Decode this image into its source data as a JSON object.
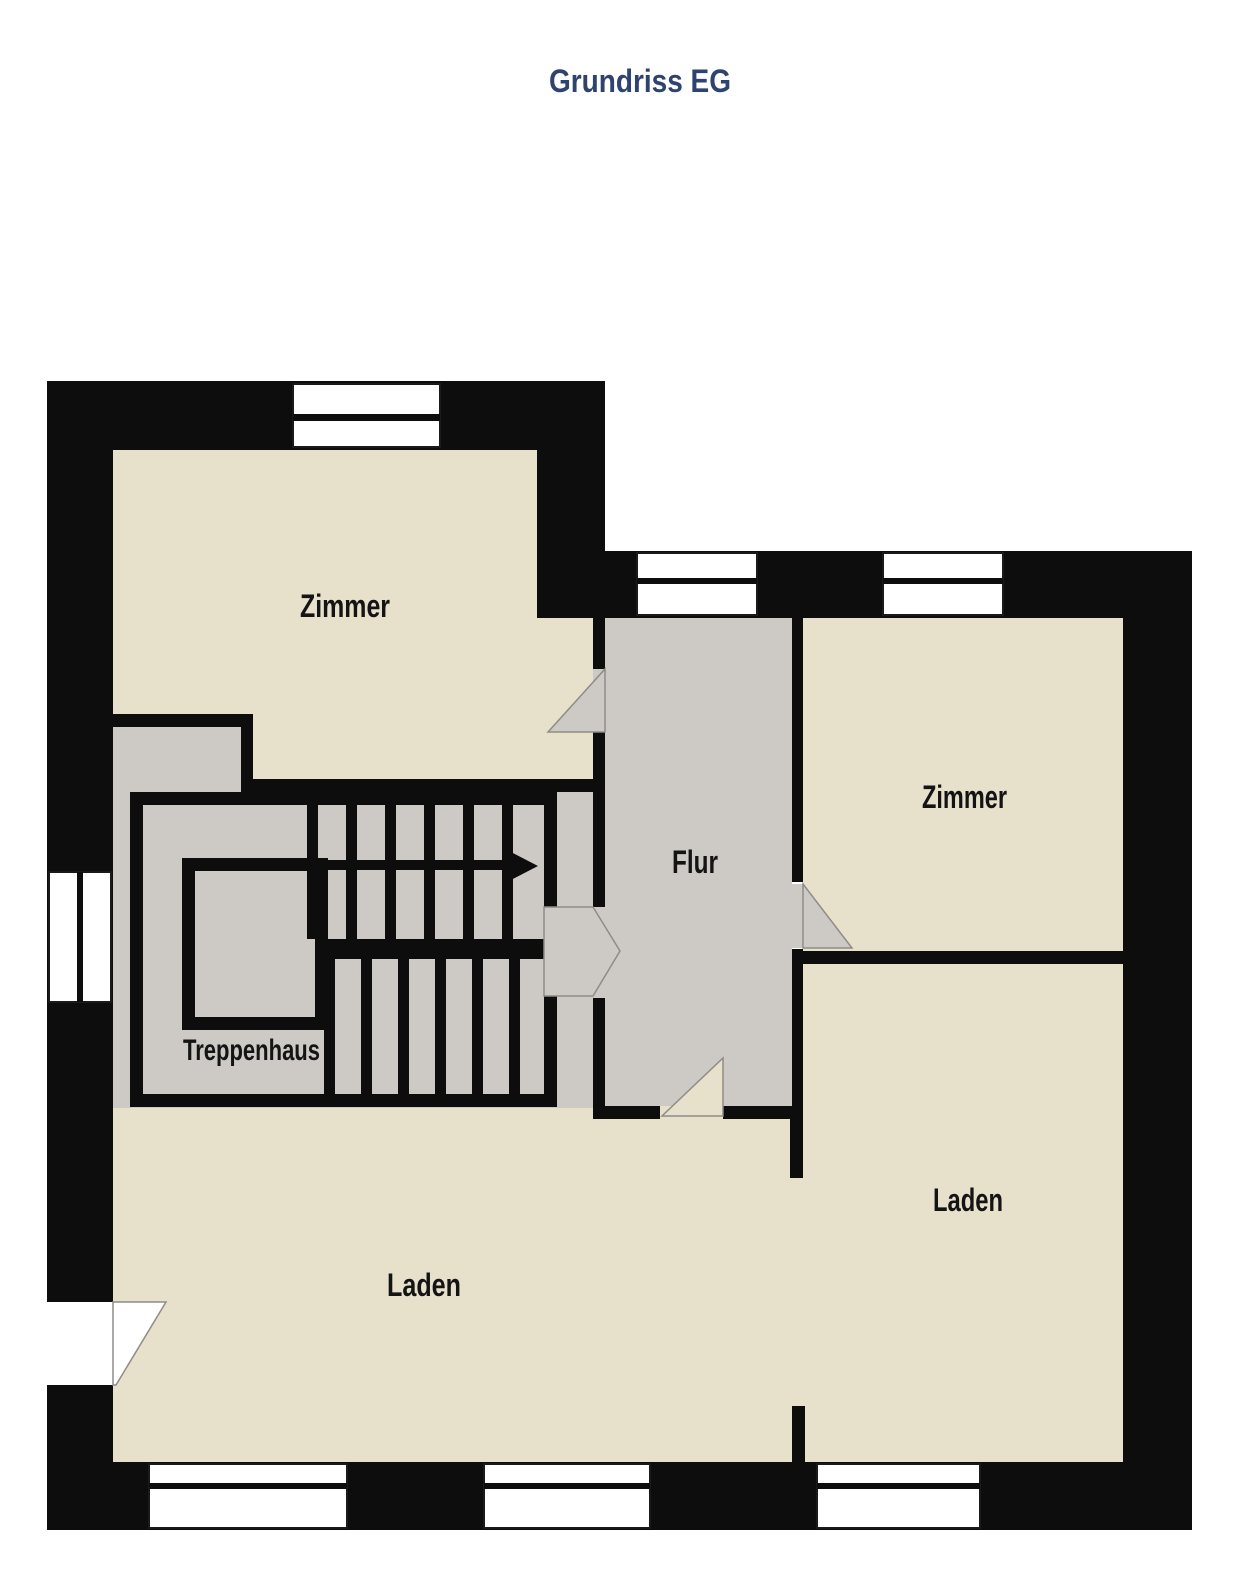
{
  "title": "Grundriss EG",
  "plan": {
    "rooms": {
      "zimmer_top_left": {
        "label": "Zimmer"
      },
      "zimmer_right": {
        "label": "Zimmer"
      },
      "flur": {
        "label": "Flur"
      },
      "treppenhaus": {
        "label": "Treppenhaus"
      },
      "laden_left": {
        "label": "Laden"
      },
      "laden_right": {
        "label": "Laden"
      }
    },
    "colors": {
      "wall": "#0d0d0d",
      "room_floor": "#e7e1cb",
      "hall_floor": "#cdcac5",
      "window": "#ffffff",
      "title_text": "#2e4370",
      "label_text": "#141414"
    }
  }
}
